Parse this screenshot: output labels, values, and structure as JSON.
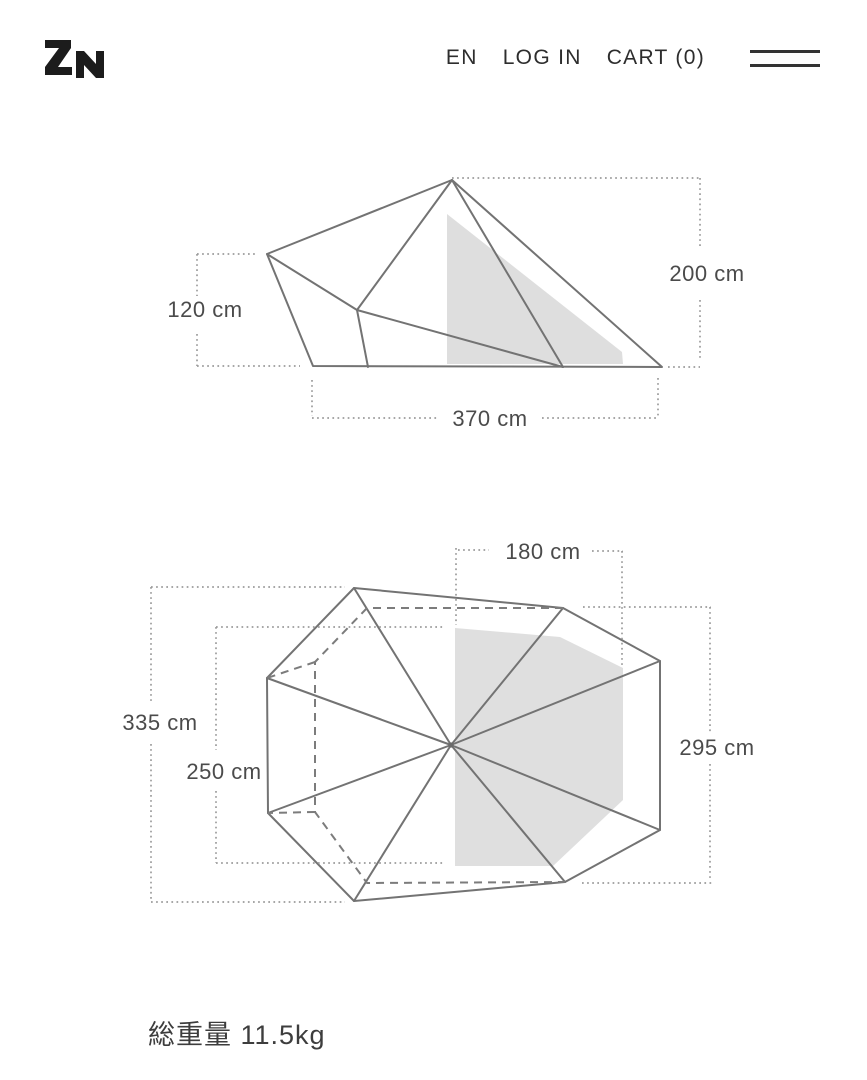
{
  "header": {
    "logo": "ZN",
    "language": "EN",
    "login": "LOG IN",
    "cart": "CART (0)",
    "menu_icon": "hamburger-icon"
  },
  "side_view": {
    "labels": {
      "height_right": "200 cm",
      "height_left": "120 cm",
      "width": "370 cm"
    }
  },
  "top_view": {
    "labels": {
      "width_top": "180 cm",
      "depth_outer": "335 cm",
      "width_inner": "250 cm",
      "depth_right": "295 cm"
    }
  },
  "footer": {
    "total_weight": "総重量 11.5kg"
  },
  "colors": {
    "solid_line": "#737373",
    "dashed_line": "#7c7c7c",
    "dotted_dimension_line": "#9b9b9b",
    "inner_room_fill": "#dadada",
    "dimension_text": "#4b4b4b",
    "header_text": "#2d2d2d",
    "logo": "#1c1c1c"
  }
}
